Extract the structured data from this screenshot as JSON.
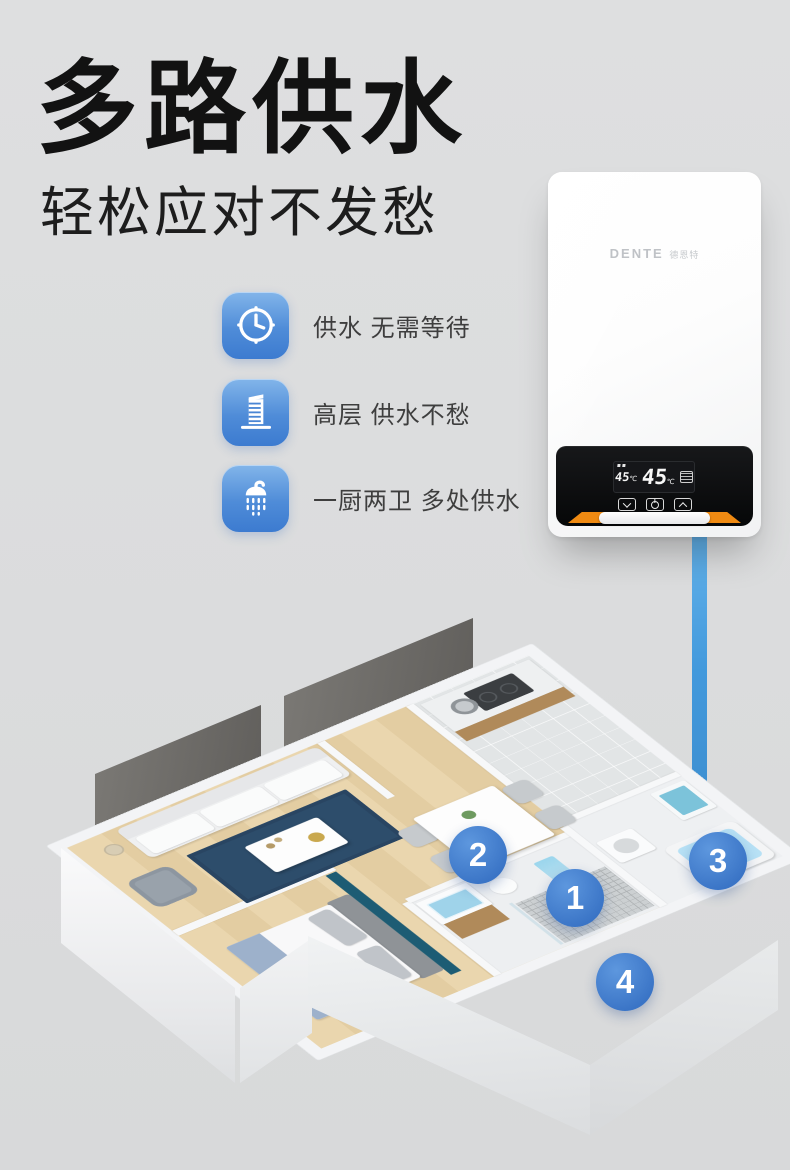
{
  "header": {
    "title": "多路供水",
    "subtitle": "轻松应对不发愁"
  },
  "features": [
    {
      "icon": "clock-icon",
      "label": "供水 无需等待"
    },
    {
      "icon": "building-icon",
      "label": "高层 供水不愁"
    },
    {
      "icon": "shower-icon",
      "label": "一厨两卫 多处供水"
    }
  ],
  "heater": {
    "brand": "DENTE",
    "brand_cn": "德恩特",
    "display": {
      "set_temp": "45",
      "set_unit": "℃",
      "out_temp": "45",
      "out_unit": "℃"
    },
    "buttons": [
      {
        "name": "temp-down"
      },
      {
        "name": "power"
      },
      {
        "name": "temp-up"
      }
    ],
    "accent_color": "#ef8a12"
  },
  "supply_line": {
    "color": "#4299dc"
  },
  "floorplan": {
    "markers": [
      {
        "label": "1"
      },
      {
        "label": "2"
      },
      {
        "label": "3"
      },
      {
        "label": "4"
      }
    ],
    "marker_color": "#3a74c6"
  },
  "colors": {
    "background": "#dcddde",
    "title_text": "#121212",
    "feature_icon_blue": "#4f8cd8",
    "rug_blue": "#2d4d6b",
    "accent_teal_wall": "#1d5c74",
    "wood_floor": "#e8d3ab",
    "cabinet_wood": "#b08a5a",
    "tub_water_blue": "#b7e1f5",
    "heater_accent_orange": "#ef8a12"
  }
}
